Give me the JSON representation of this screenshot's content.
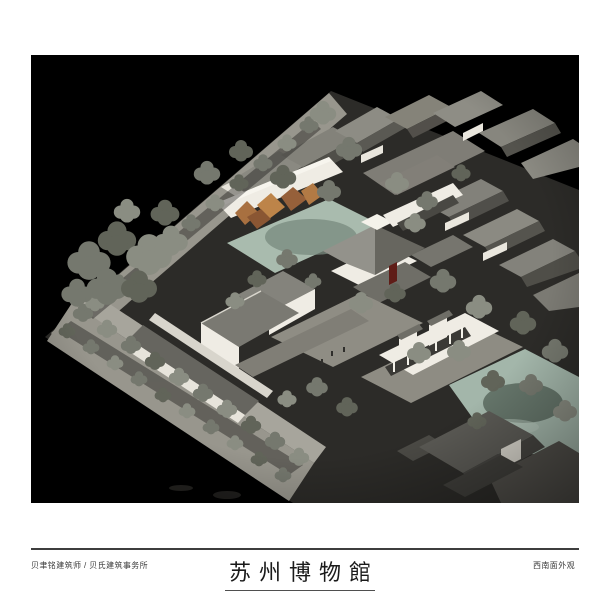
{
  "palette": {
    "page-bg": "#ffffff",
    "photo-bg": "#000000",
    "rule": "#3e3e3e",
    "caption-text": "#3a3a3a",
    "title-text": "#1a1a1a",
    "model-wall": "#efece4",
    "model-roof": "#75746e",
    "model-street": "#98968d",
    "pond": "#a9bbae",
    "canal": "#a3b6aa",
    "rockery": "#b5793f",
    "red-door": "#5f1d17"
  },
  "captions": {
    "architect": "贝聿铭建筑师 / 贝氏建筑事务所",
    "view": "西南面外观"
  },
  "title": {
    "text": "苏州博物館"
  }
}
